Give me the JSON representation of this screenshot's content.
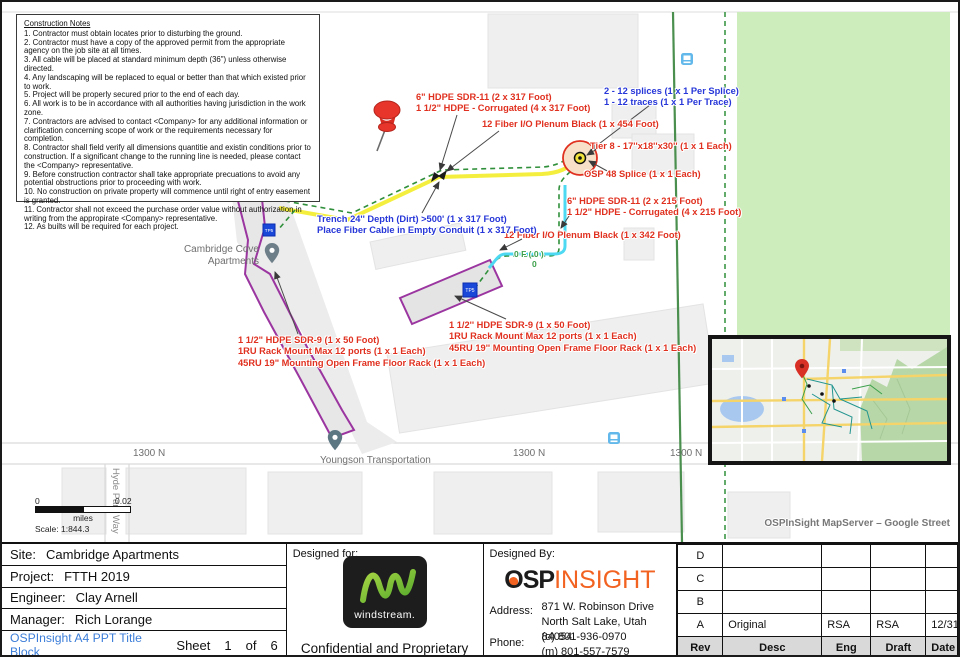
{
  "colors": {
    "annotation_red": "#e0301f",
    "annotation_blue": "#2636d8",
    "fiber_count_green": "#3da04b",
    "trench_yellow": "#f4ef3e",
    "cable_cyan": "#4ed9f2",
    "route_green": "#2f8f3a",
    "park_green": "#cdeebc",
    "building_purple": "#9b35a0",
    "template_link_blue": "#3b7dd8",
    "osp_logo_orange": "#f26322",
    "windstream_green": "#7dc242"
  },
  "notes": {
    "title": "Construction Notes",
    "items": [
      "1. Contractor must obtain locates prior to disturbing the ground.",
      "2. Contractor must have a copy of the approved permit from the  appropriate agency on the job site at all times.",
      "3. All cable will be placed at standard minimum depth (36\") unless otherwise  directed.",
      "4. Any landscaping will be replaced to equal or better than that which existed prior to work.",
      "5. Project will be properly secured prior to the end of each day.",
      "6. All work is to be in accordance with all authorities having jurisdiction in the work zone.",
      "7. Contractors are advised to contact <Company> for any additional information or clarification concerning scope of work or the requirements necessary for completion.",
      "8. Contractor shall field verify all dimensions quantitie and existin conditions prior to construction.  If a significant change to the running line is needed, please contact the <Company> representative.",
      "9. Before construction contractor shall take appropriate precuations to avoid any potential obstructions prior to proceeding with work.",
      "10. No construction on private property will commence until right of entry easement is granted.",
      "11. Contractor shall not exceed the purchase order value without authorization in writing from the appropirate <Company> representative.",
      "12. As builts will be required for each project."
    ]
  },
  "annotations": {
    "hdpe317_1": "6\" HDPE SDR-11 (2 x 317 Foot)",
    "hdpe317_2": "1 1/2\" HDPE - Corrugated (4 x 317 Foot)",
    "fiber454": "12 Fiber I/O Plenum Black (1 x 454 Foot)",
    "splices": "2 - 12 splices (1 x 1 Per Splice)",
    "traces": "1 - 12 traces (1 x 1 Per Trace)",
    "tier8": "Tier 8 - 17''x18''x30'' (1 x 1 Each)",
    "osp48": "OSP 48 Splice (1 x 1 Each)",
    "hdpe215_1": "6\" HDPE SDR-11 (2 x 215 Foot)",
    "hdpe215_2": "1 1/2\" HDPE - Corrugated (4 x 215 Foot)",
    "fiber342": "12 Fiber I/O Plenum Black (1 x 342 Foot)",
    "fiber_count": "0 F ( 0 )",
    "fiber_zero": "0",
    "trench_1": "Trench 24'' Depth  (Dirt)   >500' (1 x 317 Foot)",
    "trench_2": "Place Fiber Cable in Empty Conduit (1 x 317 Foot)",
    "rack_left_1": "1 1/2\" HDPE SDR-9 (1 x 50 Foot)",
    "rack_left_2": "1RU Rack Mount Max 12 ports (1 x 1 Each)",
    "rack_left_3": "45RU 19\" Mounting Open Frame Floor Rack (1 x 1 Each)",
    "rack_mid_1": "1 1/2'' HDPE SDR-9 (1 x 50 Foot)",
    "rack_mid_2": "1RU Rack Mount Max 12 ports (1 x 1 Each)",
    "rack_mid_3": "45RU 19'' Mounting Open Frame Floor Rack (1 x 1 Each)"
  },
  "map_labels": {
    "apartment_1": "Cambridge Cove",
    "apartment_2": "Apartments",
    "business": "Youngson Transportation",
    "street_1300n": "1300 N",
    "hyde": "Hyde Park Way",
    "tp1": "TP5",
    "tp2": "TP5"
  },
  "scalebar": {
    "zero": "0",
    "max": "0.02",
    "units": "miles",
    "ratio": "Scale: 1:844.3"
  },
  "inset": {
    "caption": "OSPInSight MapServer – Google Street"
  },
  "title_block": {
    "site_label": "Site:",
    "site": "Cambridge Apartments",
    "project_label": "Project:",
    "project": "FTTH 2019",
    "engineer_label": "Engineer:",
    "engineer": "Clay Arnell",
    "manager_label": "Manager:",
    "manager": "Rich Lorange",
    "template": "OSPInsight A4 PPT Title Block",
    "sheet_label": "Sheet",
    "sheet_num": "1",
    "of_label": "of",
    "sheet_total": "6",
    "designed_for": "Designed for:",
    "windstream_wordmark": "windstream.",
    "confidential": "Confidential and Proprietary",
    "designed_by": "Designed By:",
    "osp_logo_o": "O",
    "osp_logo_sp": "SP",
    "osp_logo_insight": "INSIGHT",
    "address_label": "Address:",
    "address_1": "871 W. Robinson Drive",
    "address_2": "North Salt Lake, Utah  84054",
    "phone_label": "Phone:",
    "phone_1": "(o) 801-936-0970",
    "phone_2": "(m) 801-557-7579",
    "rev_table": {
      "headers": [
        "Rev",
        "Desc",
        "Eng",
        "Draft",
        "Date"
      ],
      "rows": [
        {
          "rev": "D",
          "desc": "",
          "eng": "",
          "draft": "",
          "date": ""
        },
        {
          "rev": "C",
          "desc": "",
          "eng": "",
          "draft": "",
          "date": ""
        },
        {
          "rev": "B",
          "desc": "",
          "eng": "",
          "draft": "",
          "date": ""
        },
        {
          "rev": "A",
          "desc": "Original",
          "eng": "RSA",
          "draft": "RSA",
          "date": "12/31/2019"
        }
      ]
    }
  }
}
